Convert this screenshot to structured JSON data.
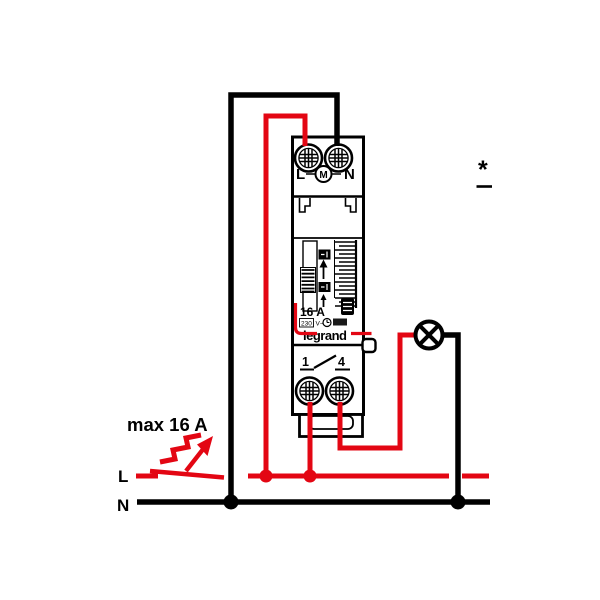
{
  "diagram_title": "staircase-time-switch-wiring-diagram",
  "colors": {
    "wire_red": "#e30613",
    "wire_black": "#000000",
    "background": "#ffffff"
  },
  "labels": {
    "line": "L",
    "neutral": "N",
    "max_current": "max 16 A",
    "asterisk": "*"
  },
  "device": {
    "terminals_top": {
      "left": "L",
      "motor": "M",
      "right": "N"
    },
    "terminals_bottom": {
      "left": "1",
      "right": "4"
    },
    "rating": "16 A",
    "voltage": "230",
    "voltage_unit": "V~",
    "brand": "legrand"
  },
  "symbols": {
    "lamp": "lamp-load",
    "push_button": "illuminated-staircase-push-button",
    "motor": "timer-motor",
    "clock": "clock-rating-icon"
  }
}
